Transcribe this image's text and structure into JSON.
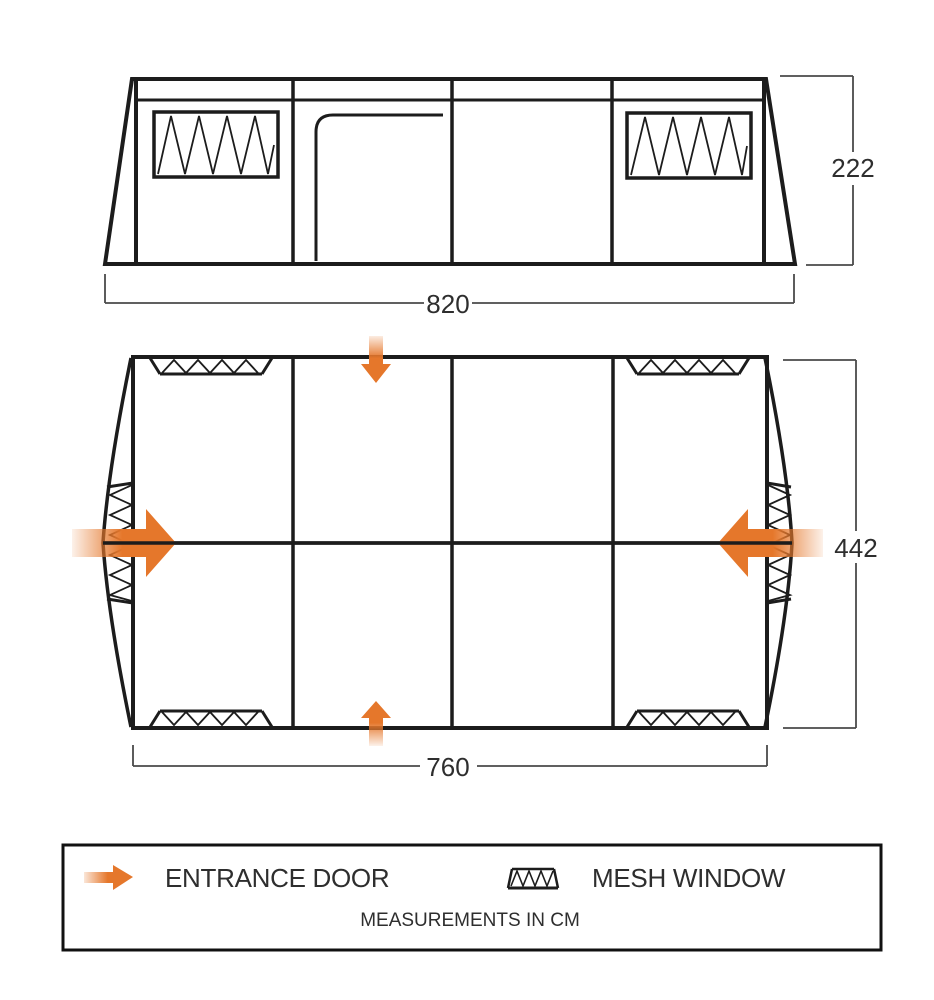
{
  "diagram": {
    "side_view": {
      "width_cm": "820",
      "height_cm": "222"
    },
    "floor_plan": {
      "width_cm": "760",
      "depth_cm": "442"
    },
    "legend": {
      "entries": [
        {
          "icon": "entrance-door-arrow-icon",
          "label": "ENTRANCE DOOR"
        },
        {
          "icon": "mesh-window-swatch-icon",
          "label": "MESH WINDOW"
        }
      ],
      "note": "MEASUREMENTS IN CM"
    },
    "colors": {
      "arrow_orange": "#E5772B",
      "outline_black": "#1C1C1C",
      "dimension_gray": "#4A4A4A"
    }
  }
}
